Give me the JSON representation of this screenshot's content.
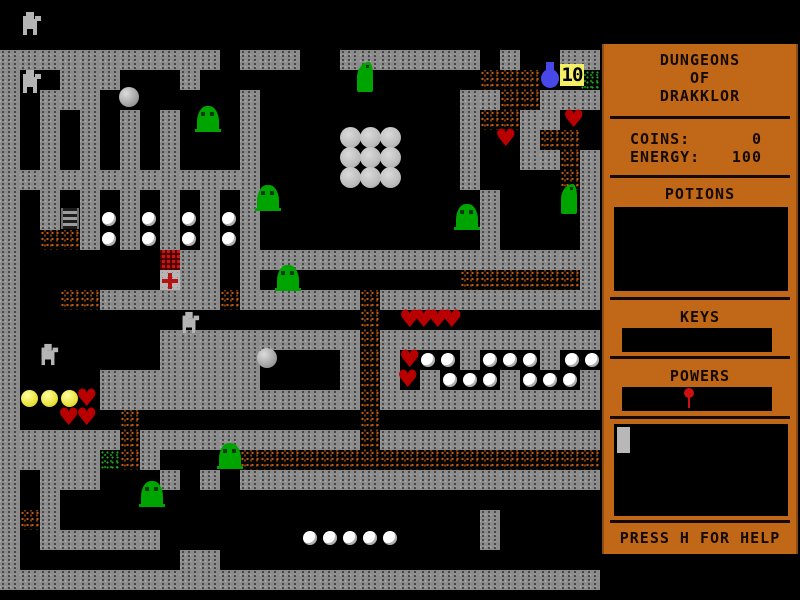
{
  "window": {
    "width": 800,
    "height": 600,
    "background": "#000000"
  },
  "sidebar": {
    "title_lines": [
      "DUNGEONS",
      "OF",
      "DRAKKLOR"
    ],
    "stats": [
      {
        "label": "COINS:",
        "value": "0"
      },
      {
        "label": "ENERGY:",
        "value": "100"
      }
    ],
    "potions_label": "POTIONS",
    "keys_label": "KEYS",
    "powers_label": "POWERS",
    "help_text": "PRESS H FOR HELP",
    "colors": {
      "panel": "#c06818",
      "text": "#140a02",
      "box": "#000000",
      "pin": "#cc1111"
    }
  },
  "hud_badge": {
    "value": "10"
  },
  "colors": {
    "wall": "#8c8c8c",
    "dirt_speckle": "#c05a10",
    "moss_speckle": "#1fae1f",
    "slime": "#00a400",
    "heart": "#b80000",
    "coin": "#e8e23c",
    "pearl": "#ffffff",
    "boulder": "#a8a8a8",
    "jug": "#4848e8",
    "badge_bg": "#f2ee66",
    "chest": "#c21717"
  },
  "map": {
    "tile_size": 20,
    "offset_y": 10,
    "legend": {
      "#": "wall",
      ".": "floor",
      "%": "dirt",
      "G": "moss",
      "C": "chest",
      "X": "cross-marker"
    },
    "glyphs": {
      "heart": "♥"
    },
    "rows": [
      "..............................",
      "..............................",
      "###########.###..#######.#..##",
      "#..###...#..............%%%..G",
      "#.###.......#..........##%%###",
      "#.#.#.#.#...#..........#%%##..",
      "#.#.#.#.#...#..........#..#%%.",
      "#.#.#.#.#...#..........#..##%#",
      "#############..........#....%#",
      "#.#.#.#.#.#.#...........#....#",
      "#.#.#.#.#.#.#...........#....#",
      "#.%%#.#.#.#.#...........#....#",
      "#.......C##.##################",
      "#.......X##.#..........%%%%%%#",
      "#..%%######%######%###########",
      "#.................%...........",
      "#.......##########%###########",
      "#.......#####....#%#...#...#..",
      "#....########....#%#.#...#...#",
      "#....#############%###########",
      "#.....%...........%...........",
      "######%###########%###########",
      "#####G%#....%%%%%%%%%%%%%%%%%%",
      "#.###...#.#.##################",
      "#.#...........................",
      "#%#.....................#.....",
      "#.######................#.....",
      "#........##...................",
      "##############################"
    ],
    "items": [
      {
        "type": "robot",
        "x": 22,
        "y": 12
      },
      {
        "type": "robot",
        "x": 22,
        "y": 70
      },
      {
        "type": "statue",
        "x": 181,
        "y": 311
      },
      {
        "type": "statue",
        "x": 40,
        "y": 343
      },
      {
        "type": "boulder",
        "x": 119,
        "y": 87
      },
      {
        "type": "boulder",
        "x": 257,
        "y": 348
      },
      {
        "type": "slime",
        "x": 197,
        "y": 106
      },
      {
        "type": "slime",
        "x": 257,
        "y": 185
      },
      {
        "type": "slime",
        "x": 277,
        "y": 265
      },
      {
        "type": "slime",
        "x": 456,
        "y": 204
      },
      {
        "type": "slime",
        "x": 219,
        "y": 443
      },
      {
        "type": "slime",
        "x": 141,
        "y": 481
      },
      {
        "type": "dino",
        "x": 357,
        "y": 62
      },
      {
        "type": "dino",
        "x": 561,
        "y": 184
      },
      {
        "type": "ladder",
        "x": 61,
        "y": 208
      },
      {
        "type": "jug",
        "x": 540,
        "y": 62
      },
      {
        "type": "badge",
        "x": 560,
        "y": 64,
        "text": "10"
      },
      {
        "type": "pearl",
        "x": 102,
        "y": 212
      },
      {
        "type": "pearl",
        "x": 142,
        "y": 212
      },
      {
        "type": "pearl",
        "x": 182,
        "y": 212
      },
      {
        "type": "pearl",
        "x": 222,
        "y": 212
      },
      {
        "type": "pearl",
        "x": 102,
        "y": 232
      },
      {
        "type": "pearl",
        "x": 142,
        "y": 232
      },
      {
        "type": "pearl",
        "x": 182,
        "y": 232
      },
      {
        "type": "pearl",
        "x": 222,
        "y": 232
      },
      {
        "type": "pearl",
        "x": 421,
        "y": 353
      },
      {
        "type": "pearl",
        "x": 441,
        "y": 353
      },
      {
        "type": "pearl",
        "x": 483,
        "y": 353
      },
      {
        "type": "pearl",
        "x": 503,
        "y": 353
      },
      {
        "type": "pearl",
        "x": 523,
        "y": 353
      },
      {
        "type": "pearl",
        "x": 565,
        "y": 353
      },
      {
        "type": "pearl",
        "x": 585,
        "y": 353
      },
      {
        "type": "pearl",
        "x": 443,
        "y": 373
      },
      {
        "type": "pearl",
        "x": 463,
        "y": 373
      },
      {
        "type": "pearl",
        "x": 483,
        "y": 373
      },
      {
        "type": "pearl",
        "x": 523,
        "y": 373
      },
      {
        "type": "pearl",
        "x": 543,
        "y": 373
      },
      {
        "type": "pearl",
        "x": 563,
        "y": 373
      },
      {
        "type": "pearl",
        "x": 303,
        "y": 531
      },
      {
        "type": "pearl",
        "x": 323,
        "y": 531
      },
      {
        "type": "pearl",
        "x": 343,
        "y": 531
      },
      {
        "type": "pearl",
        "x": 363,
        "y": 531
      },
      {
        "type": "pearl",
        "x": 383,
        "y": 531
      },
      {
        "type": "bigpearl",
        "x": 340,
        "y": 127
      },
      {
        "type": "bigpearl",
        "x": 360,
        "y": 127
      },
      {
        "type": "bigpearl",
        "x": 380,
        "y": 127
      },
      {
        "type": "bigpearl",
        "x": 340,
        "y": 147
      },
      {
        "type": "bigpearl",
        "x": 360,
        "y": 147
      },
      {
        "type": "bigpearl",
        "x": 380,
        "y": 147
      },
      {
        "type": "bigpearl",
        "x": 340,
        "y": 167
      },
      {
        "type": "bigpearl",
        "x": 360,
        "y": 167
      },
      {
        "type": "bigpearl",
        "x": 380,
        "y": 167
      },
      {
        "type": "heart",
        "x": 563,
        "y": 110
      },
      {
        "type": "heart",
        "x": 495,
        "y": 129
      },
      {
        "type": "heart",
        "x": 399,
        "y": 310
      },
      {
        "type": "heart",
        "x": 413,
        "y": 310
      },
      {
        "type": "heart",
        "x": 427,
        "y": 310
      },
      {
        "type": "heart",
        "x": 441,
        "y": 310
      },
      {
        "type": "heart",
        "x": 399,
        "y": 350
      },
      {
        "type": "heart",
        "x": 397,
        "y": 370
      },
      {
        "type": "heart",
        "x": 76,
        "y": 389
      },
      {
        "type": "heart",
        "x": 58,
        "y": 408
      },
      {
        "type": "heart",
        "x": 76,
        "y": 408
      },
      {
        "type": "coin",
        "x": 21,
        "y": 390
      },
      {
        "type": "coin",
        "x": 41,
        "y": 390
      },
      {
        "type": "coin",
        "x": 61,
        "y": 390
      }
    ]
  }
}
